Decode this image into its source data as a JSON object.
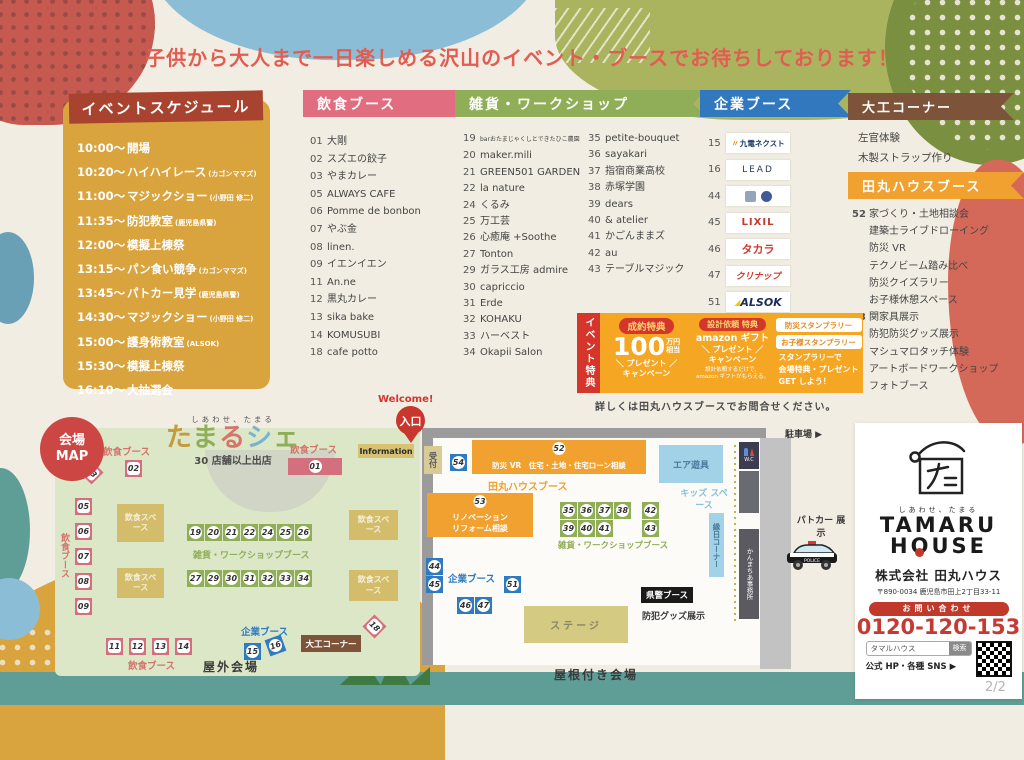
{
  "banner": {
    "text": "子供から大人まで一日楽しめる沢山のイベント・ブースでお待ちしております！"
  },
  "schedule": {
    "title": "イベントスケジュール",
    "items": [
      {
        "time": "10:00～",
        "event": "開場",
        "note": ""
      },
      {
        "time": "10:20～",
        "event": "ハイハイレース",
        "note": "(カゴンママズ)"
      },
      {
        "time": "11:00～",
        "event": "マジックショー",
        "note": "(小野田 修二)"
      },
      {
        "time": "11:35～",
        "event": "防犯教室",
        "note": "(鹿児島県警)"
      },
      {
        "time": "12:00～",
        "event": "模擬上棟祭",
        "note": ""
      },
      {
        "time": "13:15～",
        "event": "パン食い競争",
        "note": "(カゴンママズ)"
      },
      {
        "time": "13:45～",
        "event": "パトカー見学",
        "note": "(鹿児島県警)"
      },
      {
        "time": "14:30～",
        "event": "マジックショー",
        "note": "(小野田 修二)"
      },
      {
        "time": "15:00～",
        "event": "護身術教室",
        "note": "(ALSOK)"
      },
      {
        "time": "15:30～",
        "event": "模擬上棟祭",
        "note": ""
      },
      {
        "time": "16:10～",
        "event": "大抽選会",
        "note": ""
      }
    ]
  },
  "food": {
    "title": "飲食ブース",
    "items": [
      {
        "no": "01",
        "name": "大剛"
      },
      {
        "no": "02",
        "name": "スズエの餃子"
      },
      {
        "no": "03",
        "name": "やまカレー"
      },
      {
        "no": "05",
        "name": "ALWAYS CAFE"
      },
      {
        "no": "06",
        "name": "Pomme de bonbon"
      },
      {
        "no": "07",
        "name": "やぶ金"
      },
      {
        "no": "08",
        "name": "linen."
      },
      {
        "no": "09",
        "name": "イエンイエン"
      },
      {
        "no": "11",
        "name": "An.ne"
      },
      {
        "no": "12",
        "name": "黒丸カレー"
      },
      {
        "no": "13",
        "name": "sika bake"
      },
      {
        "no": "14",
        "name": "KOMUSUBI"
      },
      {
        "no": "18",
        "name": "cafe potto"
      }
    ]
  },
  "workshop": {
    "title": "雑貨・ワークショップ",
    "col1": [
      {
        "no": "19",
        "name": "barおたまじゃくしとできたひこ農園",
        "small": true
      },
      {
        "no": "20",
        "name": "maker.mili"
      },
      {
        "no": "21",
        "name": "GREEN501 GARDEN"
      },
      {
        "no": "22",
        "name": "la nature"
      },
      {
        "no": "24",
        "name": "くるみ"
      },
      {
        "no": "25",
        "name": "万工芸"
      },
      {
        "no": "26",
        "name": "心癒庵 +Soothe"
      },
      {
        "no": "27",
        "name": "Tonton"
      },
      {
        "no": "29",
        "name": "ガラス工房 admire"
      },
      {
        "no": "30",
        "name": "capriccio"
      },
      {
        "no": "31",
        "name": "Erde"
      },
      {
        "no": "32",
        "name": "KOHAKU"
      },
      {
        "no": "33",
        "name": "ハーベスト"
      },
      {
        "no": "34",
        "name": "Okapii Salon"
      }
    ],
    "col2": [
      {
        "no": "35",
        "name": "petite-bouquet"
      },
      {
        "no": "36",
        "name": "sayakari"
      },
      {
        "no": "37",
        "name": "指宿商業高校"
      },
      {
        "no": "38",
        "name": "赤塚学園"
      },
      {
        "no": "39",
        "name": "dears"
      },
      {
        "no": "40",
        "name": "& atelier"
      },
      {
        "no": "41",
        "name": "かごんままズ"
      },
      {
        "no": "42",
        "name": "au"
      },
      {
        "no": "43",
        "name": "テーブルマジック"
      }
    ]
  },
  "corporate": {
    "title": "企業ブース",
    "items": [
      {
        "no": "15",
        "logo": "九電ネクスト",
        "style": "kyuden"
      },
      {
        "no": "16",
        "logo": "LEAD",
        "style": "lead"
      },
      {
        "no": "44",
        "logo": "",
        "style": "marks"
      },
      {
        "no": "45",
        "logo": "LIXIL",
        "style": "lixil"
      },
      {
        "no": "46",
        "logo": "タカラ",
        "style": "takara"
      },
      {
        "no": "47",
        "logo": "クリナップ",
        "style": "cleanup"
      },
      {
        "no": "51",
        "logo": "ALSOK",
        "style": "alsok"
      },
      {
        "no": "54",
        "logo": "Panasonic Builders Group",
        "style": "panasonic"
      }
    ]
  },
  "carpenter": {
    "title": "大工コーナー",
    "items": [
      {
        "name": "左官体験"
      },
      {
        "name": "木製ストラップ作り"
      }
    ]
  },
  "tamaru_booth": {
    "title": "田丸ハウスブース",
    "rows": [
      {
        "no": "52",
        "text": "家づくり・土地相談会"
      },
      {
        "no": "",
        "text": "建築士ライブドローイング"
      },
      {
        "no": "",
        "text": "防災 VR"
      },
      {
        "no": "",
        "text": "テクノビーム踏み比べ"
      },
      {
        "no": "",
        "text": "防災クイズラリー"
      },
      {
        "no": "",
        "text": "お子様休憩スペース"
      },
      {
        "no": "53",
        "text": "関家具展示"
      },
      {
        "no": "",
        "text": "防犯防災グッズ展示"
      },
      {
        "no": "",
        "text": "マシュマロタッチ体験"
      },
      {
        "no": "",
        "text": "アートボードワークショップ"
      },
      {
        "no": "",
        "text": "フォトブース"
      }
    ]
  },
  "benefits": {
    "tab": "イベント特典",
    "contract_badge": "成約特典",
    "contract_amount": "100",
    "contract_unit1": "万円",
    "contract_unit2": "相当",
    "contract_line1": "＼ プレゼント ／",
    "contract_line2": "キャンペーン",
    "design_badge": "設計依頼 特典",
    "design_line0": "amazon ギフト",
    "design_line1": "＼ プレゼント ／",
    "design_line2": "キャンペーン",
    "design_note1": "設計依頼するだけで、",
    "design_note2": "amazon ギフトがもらえる。",
    "stamp_box1": "防災スタンプラリー",
    "stamp_box2": "お子様スタンプラリー",
    "stamp_text1": "スタンプラリーで",
    "stamp_text2": "会場特典・プレゼント",
    "stamp_text3": "GET しよう！",
    "footer": "詳しくは田丸ハウスブースでお問合せください。"
  },
  "map": {
    "badge1": "会場",
    "badge2": "MAP",
    "welcome": "Welcome!",
    "entrance": "入口",
    "information": "Information",
    "reception": "受付",
    "title_small": "しあわせ、たまる",
    "title_chars": [
      "た",
      "ま",
      "る",
      "シ",
      "ェ"
    ],
    "title_note": "30 店舗以上出店",
    "labels": {
      "food1": "飲食ブース",
      "food2": "飲食ブース",
      "food3": "飲食ブース",
      "food4": "飲食ブース",
      "space": "飲食スペース",
      "workshop_row": "雑貨・ワークショップブース",
      "workshop_row2": "雑貨・ワークショップブース",
      "corp_out": "企業ブース",
      "corp_in": "企業ブース",
      "daiku": "大工コーナー",
      "outdoor": "屋外会場",
      "indoor": "屋根付き会場",
      "air": "エア遊具",
      "kids": "キッズ スペース",
      "ennichi": "縁日コーナー",
      "wc": "W.C",
      "parking": "駐車場 ▶",
      "kanmachi": "かんまちあ事務所",
      "patca": "パトカー 展示",
      "kenkei": "県警ブース",
      "bohan": "防犯グッズ展示",
      "stage": "ステージ",
      "tamaru": "田丸ハウスブース",
      "b52": "防災 VR　住宅・土地・住宅ローン相談",
      "b53a": "リノベーション",
      "b53b": "リフォーム相談"
    },
    "rows": {
      "r19": [
        "19",
        "20",
        "21",
        "22",
        "24",
        "25",
        "26"
      ],
      "r27": [
        "27",
        "29",
        "30",
        "31",
        "32",
        "33",
        "34"
      ],
      "r35": [
        "35",
        "36",
        "37",
        "38"
      ],
      "r39": [
        "39",
        "40",
        "41"
      ],
      "r11": [
        "11",
        "12",
        "13",
        "14"
      ],
      "col05": [
        "05",
        "06",
        "07",
        "08",
        "09"
      ],
      "col44": [
        "44",
        "45"
      ],
      "r46": [
        "46",
        "47"
      ]
    },
    "single": {
      "n01": "01",
      "n02": "02",
      "n03": "03",
      "n15": "15",
      "n16": "16",
      "n18": "18",
      "n42": "42",
      "n43": "43",
      "n51": "51",
      "n52": "52",
      "n53": "53",
      "n54": "54"
    }
  },
  "company": {
    "logo_sub": "しあわせ、たまる",
    "logo_line1": "TAMARU",
    "name": "株式会社 田丸ハウス",
    "address": "〒890-0034 鹿児島市田上2丁目33-11",
    "contact_label": "お問い合わせ",
    "phone": "0120-120-153",
    "search_value": "タマルハウス",
    "search_button": "検索",
    "sns": "公式 HP・各種 SNS ▶",
    "page": "2/2"
  },
  "colors": {
    "accent_red": "#d4362c",
    "pink": "#e06e80",
    "green": "#8fae57",
    "blue": "#3178be",
    "brown": "#7d5439",
    "orange": "#f0a12f",
    "mustard": "#d9a43e"
  }
}
